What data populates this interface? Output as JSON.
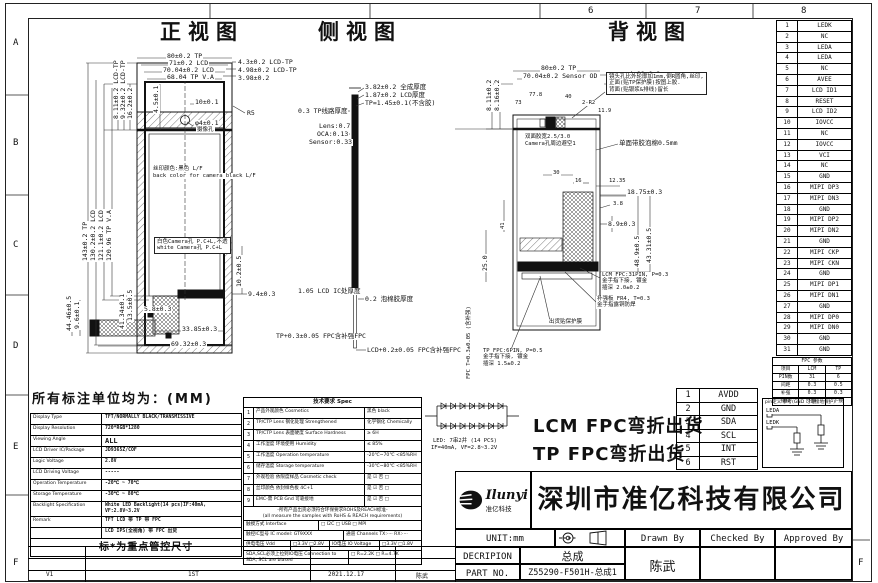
{
  "frame": {
    "top_numbers": [
      {
        "t": "6",
        "x": 588
      },
      {
        "t": "7",
        "x": 695
      },
      {
        "t": "8",
        "x": 801
      }
    ],
    "left_letters": [
      {
        "t": "A",
        "y": 38
      },
      {
        "t": "B",
        "y": 138
      },
      {
        "t": "C",
        "y": 240
      },
      {
        "t": "D",
        "y": 341
      },
      {
        "t": "E",
        "y": 442
      },
      {
        "t": "F",
        "y": 558
      }
    ],
    "right_letters": [
      {
        "t": "F",
        "y": 558
      }
    ]
  },
  "titles": {
    "front": "正视图",
    "side": "侧视图",
    "back": "背视图",
    "unit_note": "所有标注单位均为：(MM)"
  },
  "front_labels": [
    {
      "x": 166,
      "y": 53,
      "t": "80±0.2 TP"
    },
    {
      "x": 168,
      "y": 60,
      "t": "71±0.2 LCD"
    },
    {
      "x": 162,
      "y": 67,
      "t": "70.04±0.2 LCD"
    },
    {
      "x": 166,
      "y": 74,
      "t": "68.04 TP V.A"
    },
    {
      "x": 237,
      "y": 59,
      "t": "4.3±0.2 LCD-TP"
    },
    {
      "x": 237,
      "y": 67,
      "t": "4.98±0.2 LCD-TP"
    },
    {
      "x": 237,
      "y": 75,
      "t": "3.98±0.2"
    },
    {
      "x": 113,
      "y": 120,
      "t": "8.11±0.2 LCD-TP",
      "rot": -90
    },
    {
      "x": 120,
      "y": 120,
      "t": "9.32±0.2 LCD-TP",
      "rot": -90
    },
    {
      "x": 127,
      "y": 120,
      "t": "16.2±0.2",
      "rot": -90
    },
    {
      "x": 153,
      "y": 114,
      "t": "4.5±0.1",
      "rot": -90
    },
    {
      "x": 194,
      "y": 99,
      "t": "10±0.1"
    },
    {
      "x": 194,
      "y": 120,
      "t": "φ4±0.1"
    },
    {
      "x": 196,
      "y": 127,
      "t": "摄像孔",
      "cls": "tiny"
    },
    {
      "x": 246,
      "y": 110,
      "t": "R5"
    },
    {
      "x": 152,
      "y": 166,
      "t": "丝印颜色:黑色 L/F",
      "cls": "tiny"
    },
    {
      "x": 152,
      "y": 173,
      "t": "back color for camera black L/F",
      "cls": "tiny"
    },
    {
      "x": 154,
      "y": 237,
      "t": "白色Camera孔 P.C+L,不透",
      "t2": "white Camera孔 P.C+L",
      "cls": "tiny boxed"
    },
    {
      "x": 82,
      "y": 262,
      "t": "143±0.2 TP",
      "rot": -90
    },
    {
      "x": 90,
      "y": 262,
      "t": "130.2±0.2 LCD",
      "rot": -90
    },
    {
      "x": 98,
      "y": 262,
      "t": "121.1±0.2 LCD",
      "rot": -90
    },
    {
      "x": 106,
      "y": 262,
      "t": "120.96 TP V.A",
      "rot": -90
    },
    {
      "x": 66,
      "y": 332,
      "t": "44.46±0.5",
      "rot": -90
    },
    {
      "x": 74,
      "y": 330,
      "t": "9.6±0.1",
      "rot": -90
    },
    {
      "x": 119,
      "y": 330,
      "t": "41.34±0.1",
      "rot": -90
    },
    {
      "x": 127,
      "y": 322,
      "t": "13.5±0.5",
      "rot": -90
    },
    {
      "x": 143,
      "y": 306,
      "t": "5.8±0.3"
    },
    {
      "x": 236,
      "y": 288,
      "t": "10.2±0.5",
      "rot": -90
    },
    {
      "x": 247,
      "y": 291,
      "t": "9.4±0.3"
    },
    {
      "x": 181,
      "y": 326,
      "t": "33.85±0.3"
    },
    {
      "x": 170,
      "y": 341,
      "t": "69.32±0.3"
    }
  ],
  "side_labels": [
    {
      "x": 364,
      "y": 84,
      "t": "3.82±0.2 全成厚度"
    },
    {
      "x": 364,
      "y": 92,
      "t": "1.87±0.2 LCD厚度"
    },
    {
      "x": 364,
      "y": 100,
      "t": "TP=1.45±0.1(不含胶)"
    },
    {
      "x": 297,
      "y": 108,
      "t": "0.3 TP线路厚度"
    },
    {
      "x": 318,
      "y": 123,
      "t": "Lens:0.7"
    },
    {
      "x": 316,
      "y": 131,
      "t": "OCA:0.13"
    },
    {
      "x": 308,
      "y": 139,
      "t": "Sensor:0.33"
    },
    {
      "x": 297,
      "y": 288,
      "t": "1.05 LCD IC处厚度"
    },
    {
      "x": 364,
      "y": 296,
      "t": "0.2 泡棉胶厚度"
    },
    {
      "x": 275,
      "y": 333,
      "t": "TP+0.3±0.05 FPC含补强FPC"
    },
    {
      "x": 366,
      "y": 347,
      "t": "LCD+0.2±0.05 FPC含补强FPC"
    }
  ],
  "back_labels": [
    {
      "x": 540,
      "y": 65,
      "t": "80±0.2 TP"
    },
    {
      "x": 522,
      "y": 73,
      "t": "70.04±0.2 Sensor OD"
    },
    {
      "x": 628,
      "y": 71,
      "t": "4.98±0.2"
    },
    {
      "x": 628,
      "y": 80,
      "t": "4.3±0.2"
    },
    {
      "x": 528,
      "y": 92,
      "t": "77.8",
      "cls": "tiny"
    },
    {
      "x": 514,
      "y": 100,
      "t": "73",
      "cls": "tiny"
    },
    {
      "x": 564,
      "y": 94,
      "t": "40",
      "cls": "tiny"
    },
    {
      "x": 581,
      "y": 100,
      "t": "2-R2",
      "cls": "tiny"
    },
    {
      "x": 597,
      "y": 108,
      "t": "11.9",
      "cls": "tiny"
    },
    {
      "x": 486,
      "y": 112,
      "t": "8.11±0.2",
      "rot": -90
    },
    {
      "x": 494,
      "y": 112,
      "t": "8.16±0.2",
      "rot": -90
    },
    {
      "x": 606,
      "y": 72,
      "t": "镜头孔比外轮廓加1mm,倒R圆角,丝印,",
      "t2": "正面(贴TP保护膜)按图上胶.",
      "t3": "背面(贴银浆&排线)留长",
      "cls": "tiny boxed"
    },
    {
      "x": 618,
      "y": 140,
      "t": "单面带胶泡棉0.5mm"
    },
    {
      "x": 524,
      "y": 134,
      "t": "双面胶宽2.5/3.0",
      "cls": "tiny"
    },
    {
      "x": 524,
      "y": 141,
      "t": "Camera孔周边避空1",
      "cls": "tiny"
    },
    {
      "x": 552,
      "y": 170,
      "t": "30",
      "cls": "tiny"
    },
    {
      "x": 574,
      "y": 178,
      "t": "16",
      "cls": "tiny"
    },
    {
      "x": 608,
      "y": 178,
      "t": "12.35",
      "cls": "tiny"
    },
    {
      "x": 626,
      "y": 189,
      "t": "18.75±0.3"
    },
    {
      "x": 612,
      "y": 201,
      "t": "3.8",
      "cls": "tiny"
    },
    {
      "x": 607,
      "y": 221,
      "t": "8.9±0.3"
    },
    {
      "x": 634,
      "y": 268,
      "t": "48.9±0.5",
      "rot": -90
    },
    {
      "x": 646,
      "y": 264,
      "t": "43.31±0.5",
      "rot": -90
    },
    {
      "x": 482,
      "y": 272,
      "t": "25.0",
      "rot": -90
    },
    {
      "x": 500,
      "y": 230,
      "t": "41",
      "rot": -90,
      "cls": "tiny"
    },
    {
      "x": 601,
      "y": 272,
      "t": "LCM FPC:31PIN, P=0.3",
      "t2": "金手指下接, 镀金",
      "t3": "插深 2.0±0.2",
      "cls": "tiny"
    },
    {
      "x": 596,
      "y": 296,
      "t": "补强板 FR4, T=0.3",
      "t2": "金手指露铜防焊",
      "cls": "tiny"
    },
    {
      "x": 548,
      "y": 319,
      "t": "出货贴保护膜",
      "cls": "tiny"
    },
    {
      "x": 482,
      "y": 348,
      "t": "TP FPC:6PIN, P=0.5",
      "t2": "金手指下接, 镀金",
      "t3": "插深 1.5±0.2",
      "cls": "tiny"
    },
    {
      "x": 466,
      "y": 380,
      "t": "FPC T=0.3±0.05 (含补强)",
      "rot": -90,
      "cls": "tiny"
    }
  ],
  "pin_rows": [
    {
      "no": "1",
      "name": "LEDK"
    },
    {
      "no": "2",
      "name": "NC"
    },
    {
      "no": "3",
      "name": "LEDA"
    },
    {
      "no": "4",
      "name": "LEDA"
    },
    {
      "no": "5",
      "name": "NC"
    },
    {
      "no": "6",
      "name": "AVEE"
    },
    {
      "no": "7",
      "name": "LCD ID1"
    },
    {
      "no": "8",
      "name": "RESET"
    },
    {
      "no": "9",
      "name": "LCD ID2"
    },
    {
      "no": "10",
      "name": "IOVCC"
    },
    {
      "no": "11",
      "name": "NC"
    },
    {
      "no": "12",
      "name": "IOVCC"
    },
    {
      "no": "13",
      "name": "VCI"
    },
    {
      "no": "14",
      "name": "NC"
    },
    {
      "no": "15",
      "name": "GND"
    },
    {
      "no": "16",
      "name": "MIPI DP3"
    },
    {
      "no": "17",
      "name": "MIPI DN3"
    },
    {
      "no": "18",
      "name": "GND"
    },
    {
      "no": "19",
      "name": "MIPI DP2"
    },
    {
      "no": "20",
      "name": "MIPI DN2"
    },
    {
      "no": "21",
      "name": "GND"
    },
    {
      "no": "22",
      "name": "MIPI CKP"
    },
    {
      "no": "23",
      "name": "MIPI CKN"
    },
    {
      "no": "24",
      "name": "GND"
    },
    {
      "no": "25",
      "name": "MIPI DP1"
    },
    {
      "no": "26",
      "name": "MIPI DN1"
    },
    {
      "no": "27",
      "name": "GND"
    },
    {
      "no": "28",
      "name": "MIPI DP0"
    },
    {
      "no": "29",
      "name": "MIPI DN0"
    },
    {
      "no": "30",
      "name": "GND"
    },
    {
      "no": "31",
      "name": "GND"
    }
  ],
  "fpc_table": {
    "title": "FPC 参数",
    "head": [
      "项目",
      "LCM",
      "TP"
    ],
    "rows": [
      [
        "PIN数",
        "31",
        "6"
      ],
      [
        "间距",
        "0.3",
        "0.5"
      ],
      [
        "补强",
        "0.3",
        "0.3"
      ],
      [
        "插接",
        "下接",
        "下接"
      ]
    ]
  },
  "spec": {
    "rows": [
      {
        "label": "Display Type",
        "value": "TFT/NORMALLY BLACK/TRANSMISSIVE"
      },
      {
        "label": "Display Resolution",
        "value": "720*RGB*1280"
      },
      {
        "label": "Viewing Angle",
        "value": "ALL",
        "big": true
      },
      {
        "label": "LCD Driver IC/Package",
        "value": "JD9365Z/COF"
      },
      {
        "label": "Logic Voltage",
        "value": "2.8V"
      },
      {
        "label": "LCD Driving Voltage",
        "value": "-----"
      },
      {
        "label": "Operation Temperature",
        "value": "-20℃ ~ 70℃"
      },
      {
        "label": "Storage Temperature",
        "value": "-30℃ ~ 80℃"
      },
      {
        "label": "Backlight Specification",
        "value": "White LED Backlight(14 pcs)",
        "value2": "IF:40mA, VF:2.8V~3.2V"
      },
      {
        "label": "Remark",
        "value": "TFT LCD 带 TP 带 FPC"
      },
      {
        "label": "",
        "value": "LCD IPS(全视角) 带 FPC 出货"
      }
    ],
    "note": "标*为重点管控尺寸"
  },
  "tech": {
    "title": "技术要求 Spec",
    "rows": [
      {
        "no": "1",
        "desc": "产品外观颜色 Cosmetics",
        "val": "黑色 black"
      },
      {
        "no": "2",
        "desc": "TP/CTP Lens 钢化处理 Strengthened",
        "val": "化学钢化 Chemically"
      },
      {
        "no": "3",
        "desc": "TP/CTP Lens 表面硬度 Surface Hardness",
        "val": "≥ 6H"
      },
      {
        "no": "4",
        "desc": "工作湿度 环境使用 Humidity",
        "val": "≤ 85%"
      },
      {
        "no": "5",
        "desc": "工作温度 Operation temperature",
        "val": "-20℃~70℃ <85%RH"
      },
      {
        "no": "6",
        "desc": "储存温度 Storage temperature",
        "val": "-30℃~80℃ <85%RH"
      },
      {
        "no": "7",
        "desc": "外观检验 依限度样品 Cosmetic check",
        "val": "是 ☑    否 □"
      },
      {
        "no": "8",
        "desc": "丝印颜色 依封样色板 4C+1",
        "val": "是 ☑    否 □"
      },
      {
        "no": "9",
        "desc": "EMC-需 PCB Gnd 可靠接地",
        "val": "是 ☑    否 □"
      }
    ],
    "rohs1": "-所有产品出货必须符合环保要求ROHS及REACH标准-",
    "rohs2": "(all measure the samples with RoHS & REACH requirements)",
    "interface_label": "触摸方式 Interface",
    "interface_opts": "□ I2C      □ USB      □ MPI",
    "ic_label": "触控IC型号 IC model: GT9XXX",
    "channels": "通道 Channels  TX:····  RX:····",
    "vdd_label": "供电电压 Vdd",
    "vdd_opts": "□3.3V □2.8V",
    "io_label": "IO电压 IO Voltage",
    "io_opts": "□3.3V □1.8V",
    "pullup_label": "SDA,SCL必须上拉到IO电压 Connection to SDA, SCL are biased",
    "pullup_opts": "□ R=2.2K    □ R=4.7K"
  },
  "led": {
    "line1": "LED: 7串2并 (14 PCS)",
    "line2": "IF=40mA, VF=2.8~3.2V"
  },
  "ship": {
    "lcm": "LCM FPC弯折出货",
    "tp": "TP FPC弯折出货"
  },
  "tp_pins": [
    {
      "no": "1",
      "name": "AVDD"
    },
    {
      "no": "2",
      "name": "GND"
    },
    {
      "no": "3",
      "name": "SDA"
    },
    {
      "no": "4",
      "name": "SCL"
    },
    {
      "no": "5",
      "name": "INT"
    },
    {
      "no": "6",
      "name": "RST"
    }
  ],
  "pin_note": {
    "title": "pin定义 参考(GND 可靠接地保护)",
    "a": "LEDA",
    "k": "LEDK"
  },
  "title_block": {
    "logo_text": "Ilunyi",
    "logo_sub": "准亿科技",
    "company": "深圳市准亿科技有限公司",
    "unit": "UNIT:mm",
    "drawn_by": "Drawn By",
    "checked_by": "Checked By",
    "approved_by": "Approved By",
    "decription_label": "DECRIPION",
    "decription": "总成",
    "part_no_label": "PART NO.",
    "part_no": "Z55290-F501H-总成1",
    "drawn_name": "陈武"
  },
  "revision": {
    "ver": "V1",
    "desc": "1ST",
    "date": "2021.12.17",
    "by": "陈武"
  }
}
